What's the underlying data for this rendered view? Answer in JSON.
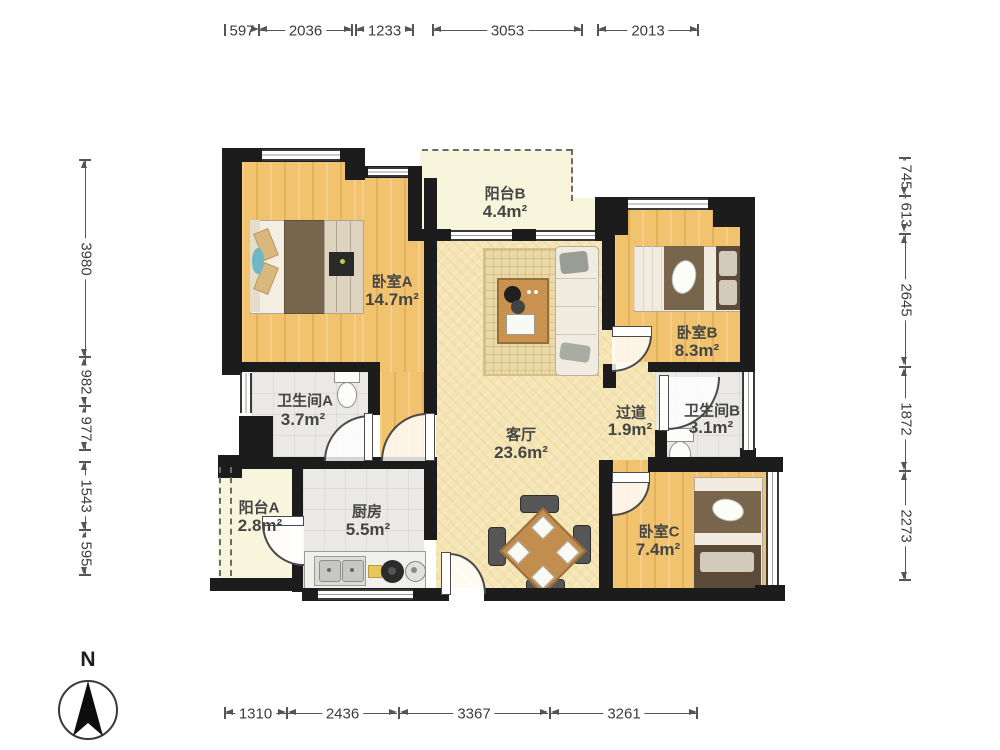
{
  "plan": {
    "rooms": {
      "bedroom_a": {
        "name": "卧室A",
        "area": "14.7m²"
      },
      "balcony_b": {
        "name": "阳台B",
        "area": "4.4m²"
      },
      "bedroom_b": {
        "name": "卧室B",
        "area": "8.3m²"
      },
      "bathroom_a": {
        "name": "卫生间A",
        "area": "3.7m²"
      },
      "living_room": {
        "name": "客厅",
        "area": "23.6m²"
      },
      "hallway": {
        "name": "过道",
        "area": "1.9m²"
      },
      "bathroom_b": {
        "name": "卫生间B",
        "area": "3.1m²"
      },
      "balcony_a": {
        "name": "阳台A",
        "area": "2.8m²"
      },
      "kitchen": {
        "name": "厨房",
        "area": "5.5m²"
      },
      "bedroom_c": {
        "name": "卧室C",
        "area": "7.4m²"
      }
    },
    "dimensions_mm": {
      "top": [
        "597",
        "2036",
        "1233",
        "3053",
        "2013"
      ],
      "bottom": [
        "1310",
        "2436",
        "3367",
        "3261"
      ],
      "left": [
        "3980",
        "982",
        "977",
        "1543",
        "595"
      ],
      "right": [
        "745",
        "613",
        "2645",
        "1872",
        "2273"
      ]
    },
    "compass": {
      "north_label": "N"
    },
    "colors": {
      "wall": "#1c1c1c",
      "wood_floor": "#f2c36e",
      "living_floor": "#f5e5b4",
      "tile_floor": "#eae9e6",
      "balcony_floor": "#f8f5dd"
    }
  }
}
